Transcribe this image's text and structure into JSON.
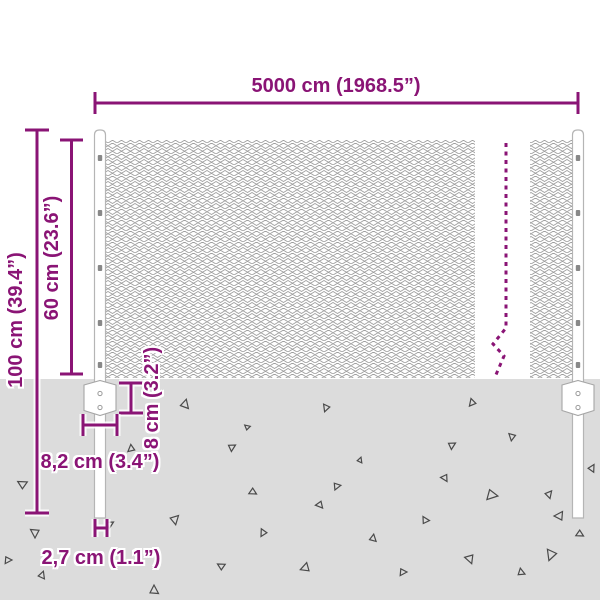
{
  "diagram": {
    "type": "product-dimension-diagram",
    "subject": "chain-link fence mesh with two posts set into the ground"
  },
  "dimensions": {
    "width": {
      "label": "5000 cm (1968.5”)"
    },
    "total_height": {
      "label": "100 cm (39.4”)"
    },
    "fence_height": {
      "label": "60 cm (23.6”)"
    },
    "bracket_offset": {
      "label": "8 cm (3.2”)"
    },
    "bracket_width": {
      "label": "8,2 cm (3.4”)"
    },
    "post_diameter": {
      "label": "2,7 cm (1.1”)"
    }
  },
  "colors": {
    "dimension_accent": "#8A1475",
    "ground": "#DCDCDC",
    "mesh_line": "#9E9E9E",
    "triangle_outline": "#4A4A4A",
    "post_outline": "#B5B5B5",
    "background": "#FFFFFF"
  }
}
